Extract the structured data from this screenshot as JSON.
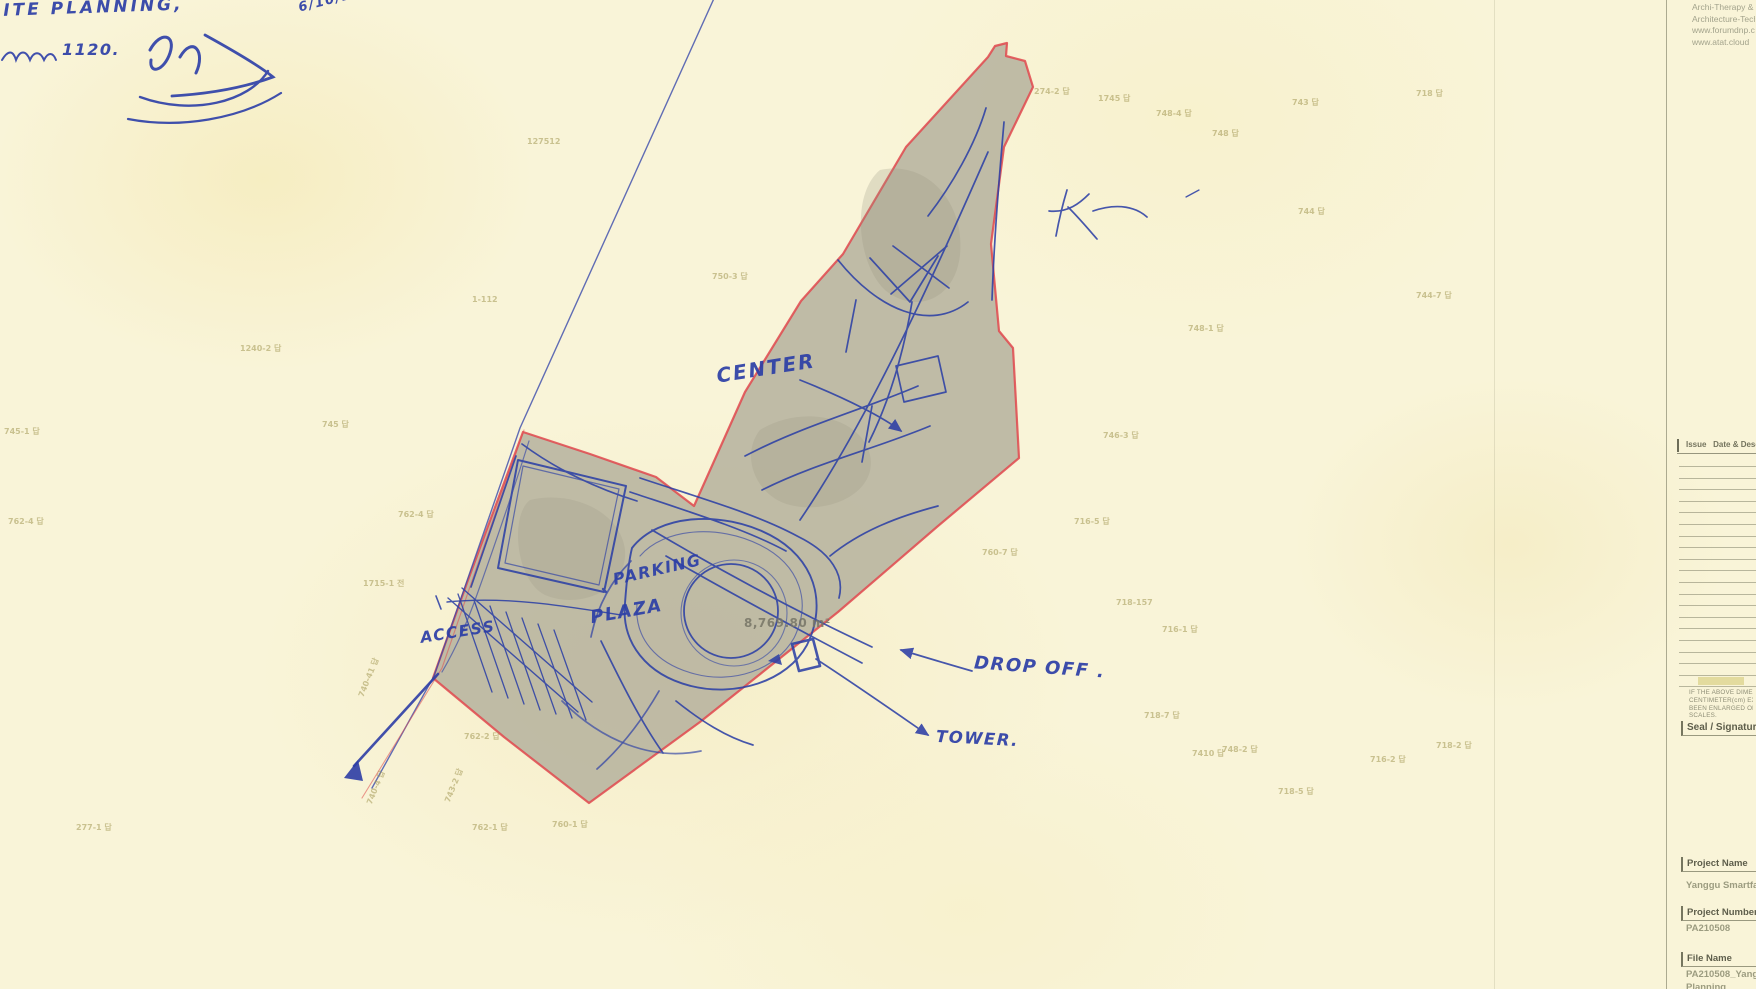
{
  "handwritten": {
    "site_note": "SITE PLANNING,",
    "memo_note": "1120.",
    "date_note": "6/10/2",
    "labels": {
      "center": "CENTER",
      "parking": "PARKING",
      "plaza": "PLAZA",
      "access": "ACCESS",
      "drop_off": "DROP OFF .",
      "tower": "TOWER."
    }
  },
  "site": {
    "area_label": "8,769.80 m²"
  },
  "parcel_labels": [
    {
      "t": "274-2 답",
      "x": 1034,
      "y": 86,
      "r": 0
    },
    {
      "t": "1745 답",
      "x": 1098,
      "y": 93,
      "r": 0
    },
    {
      "t": "748-4 답",
      "x": 1156,
      "y": 108,
      "r": 0
    },
    {
      "t": "743 답",
      "x": 1292,
      "y": 97,
      "r": 0
    },
    {
      "t": "718 답",
      "x": 1416,
      "y": 88,
      "r": 0
    },
    {
      "t": "748 답",
      "x": 1212,
      "y": 128,
      "r": 0
    },
    {
      "t": "127512",
      "x": 527,
      "y": 137,
      "r": 0
    },
    {
      "t": "744 답",
      "x": 1298,
      "y": 206,
      "r": 0
    },
    {
      "t": "750-3 답",
      "x": 712,
      "y": 271,
      "r": 0
    },
    {
      "t": "1-112",
      "x": 472,
      "y": 295,
      "r": 0
    },
    {
      "t": "744-7 답",
      "x": 1416,
      "y": 290,
      "r": 0
    },
    {
      "t": "748-1 답",
      "x": 1188,
      "y": 323,
      "r": 0
    },
    {
      "t": "1240-2 답",
      "x": 240,
      "y": 343,
      "r": 0
    },
    {
      "t": "745 답",
      "x": 322,
      "y": 419,
      "r": 0
    },
    {
      "t": "745-1 답",
      "x": 4,
      "y": 426,
      "r": 0
    },
    {
      "t": "762-4 답",
      "x": 8,
      "y": 516,
      "r": 0
    },
    {
      "t": "762-4 답",
      "x": 398,
      "y": 509,
      "r": 0
    },
    {
      "t": "1715-1 전",
      "x": 363,
      "y": 578,
      "r": 0
    },
    {
      "t": "746-3 답",
      "x": 1103,
      "y": 430,
      "r": 0
    },
    {
      "t": "716-5 답",
      "x": 1074,
      "y": 516,
      "r": 0
    },
    {
      "t": "760-7 답",
      "x": 982,
      "y": 547,
      "r": 0
    },
    {
      "t": "718-157",
      "x": 1116,
      "y": 598,
      "r": 0
    },
    {
      "t": "716-1 답",
      "x": 1162,
      "y": 624,
      "r": 0
    },
    {
      "t": "740-41 답",
      "x": 348,
      "y": 672,
      "r": -68
    },
    {
      "t": "740-4 답",
      "x": 358,
      "y": 782,
      "r": -68
    },
    {
      "t": "743-2 답",
      "x": 436,
      "y": 780,
      "r": -68
    },
    {
      "t": "277-1 답",
      "x": 76,
      "y": 822,
      "r": 0
    },
    {
      "t": "762-2 답",
      "x": 464,
      "y": 731,
      "r": 0
    },
    {
      "t": "762-1 답",
      "x": 472,
      "y": 822,
      "r": 0
    },
    {
      "t": "760-1 답",
      "x": 552,
      "y": 819,
      "r": 0
    },
    {
      "t": "718-7 답",
      "x": 1144,
      "y": 710,
      "r": 0
    },
    {
      "t": "7410 답",
      "x": 1192,
      "y": 748,
      "r": 0
    },
    {
      "t": "748-2 답",
      "x": 1222,
      "y": 744,
      "r": 0
    },
    {
      "t": "718-5 답",
      "x": 1278,
      "y": 786,
      "r": 0
    },
    {
      "t": "716-2 답",
      "x": 1370,
      "y": 754,
      "r": 0
    },
    {
      "t": "718-2 답",
      "x": 1436,
      "y": 740,
      "r": 0
    }
  ],
  "titleblock": {
    "firm_lines": [
      "Archi-Therapy &",
      "Architecture-Techn",
      "www.forumdnp.com",
      "www.atat.cloud"
    ],
    "revision": {
      "col1": "Issue",
      "col2": "Date & Descr"
    },
    "note_lines": [
      "IF THE ABOVE DIMENSION",
      "CENTIMETER(cm) EXACTLY",
      "BEEN ENLARGED OR REDUC",
      "SCALES."
    ],
    "seal_header": "Seal / Signature",
    "fields": {
      "project_name": {
        "label": "Project Name",
        "value": "Yanggu Smartfarm"
      },
      "project_number": {
        "label": "Project Number",
        "value": "PA210508"
      },
      "file_name": {
        "label": "File Name",
        "value": "PA210508_Yanggu",
        "value2": "Planning"
      }
    }
  }
}
